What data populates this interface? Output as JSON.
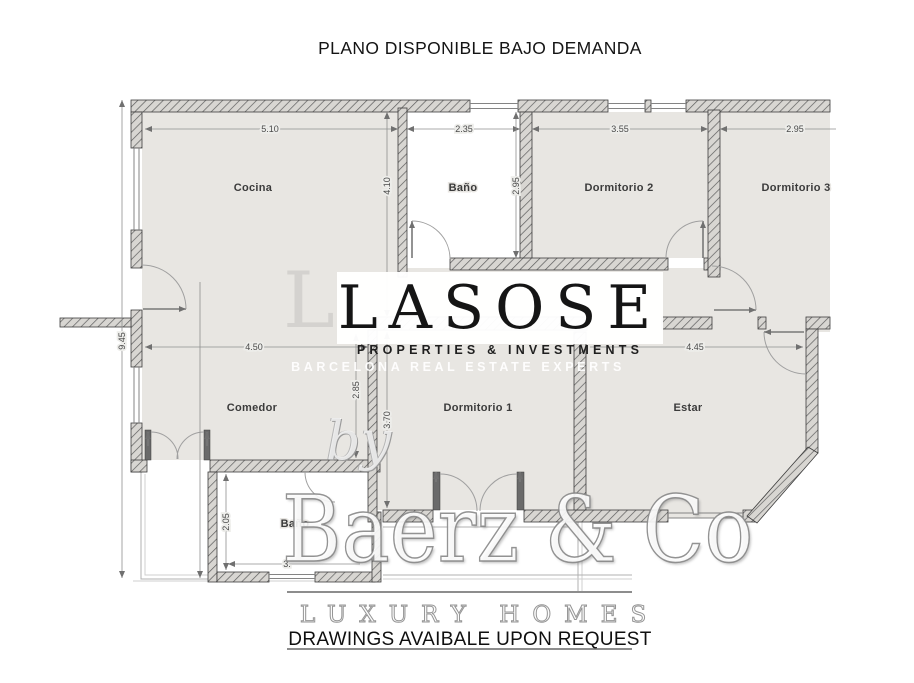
{
  "title": "PLANO DISPONIBLE BAJO DEMANDA",
  "footer_note": "DRAWINGS AVAIBALE UPON REQUEST",
  "watermark": {
    "brand": "LASOSE",
    "brand_ghost": "L",
    "tagline": "PROPERTIES & INVESTMENTS",
    "subtagline": "BARCELONA REAL ESTATE EXPERTS",
    "by_text": "by",
    "partner": "Baerz & Co",
    "partner_tagline": "LUXURY HOMES"
  },
  "rooms": {
    "cocina": "Cocina",
    "bano": "Baño",
    "dormitorio2": "Dormitorio 2",
    "dormitorio3": "Dormitorio 3",
    "comedor": "Comedor",
    "dormitorio1": "Dormitorio 1",
    "estar": "Estar",
    "bano2": "Baño"
  },
  "dimensions": {
    "cocina_width": "5.10",
    "bano_width": "2.35",
    "dorm2_width": "3.55",
    "dorm3_width": "2.95",
    "cocina_depth": "4.10",
    "bano_depth": "2.95",
    "total_depth": "9.45",
    "comedor_width": "4.50",
    "comedor_depth": "2.85",
    "dorm1_depth": "3.70",
    "estar_width": "4.45",
    "bano2_depth": "2.05",
    "bano2_width": "3."
  },
  "colors": {
    "room_fill": "#e8e6e2",
    "wall_edge": "#3d3d3d",
    "dim_text": "#4a4a4a"
  }
}
